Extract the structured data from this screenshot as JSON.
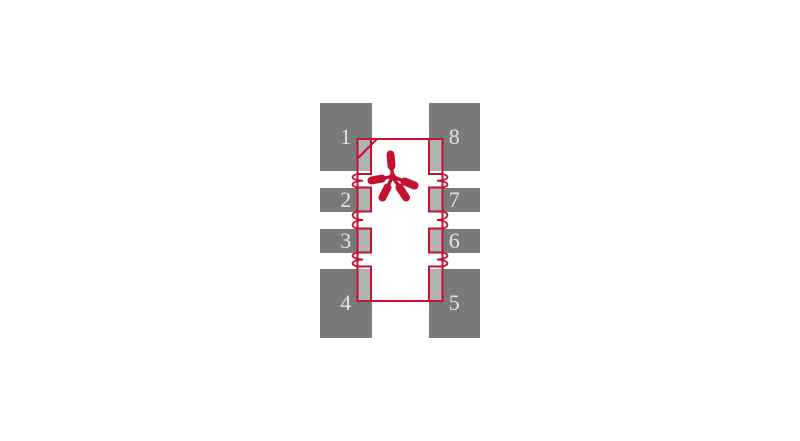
{
  "footprint": {
    "description": "8-pad surface-mount land pattern diagram",
    "pin_one_marker": "asterisk",
    "pin_one_corner": "chamfered-top-left",
    "colors": {
      "silkscreen_red": "#c2122e",
      "pad_gray": "#7a7a7a",
      "label_color": "#e3e3e3",
      "background": "#ffffff"
    },
    "pads": [
      {
        "label": "1",
        "side": "left",
        "row": 1
      },
      {
        "label": "2",
        "side": "left",
        "row": 2
      },
      {
        "label": "3",
        "side": "left",
        "row": 3
      },
      {
        "label": "4",
        "side": "left",
        "row": 4
      },
      {
        "label": "5",
        "side": "right",
        "row": 4
      },
      {
        "label": "6",
        "side": "right",
        "row": 3
      },
      {
        "label": "7",
        "side": "right",
        "row": 2
      },
      {
        "label": "8",
        "side": "right",
        "row": 1
      }
    ]
  }
}
